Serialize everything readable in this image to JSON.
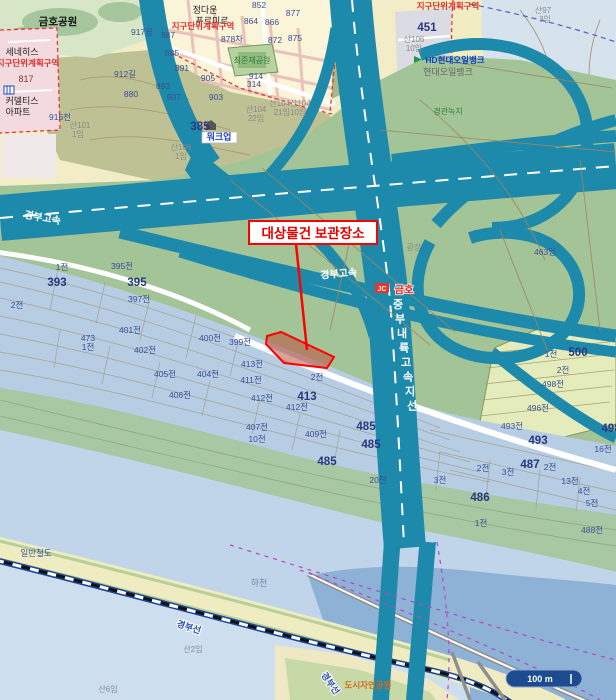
{
  "map": {
    "annotation": {
      "label": "대상물건 보관장소"
    },
    "scale_bar": {
      "label": "100 m"
    },
    "junction": {
      "badge": "JC",
      "name": "금호"
    },
    "colors": {
      "highway_teal": "#1e8aab",
      "interchange_green": "#a3c497",
      "parcel_blue": "#b6cde4",
      "river_blue": "#8db2d6",
      "railway_blue": "#1c4694",
      "annotation_red": "#ff0000",
      "district_pink": "#f3dade",
      "land_yellow": "#f2edc6",
      "scalebar_navy": "#1d4b8f"
    },
    "labels": [
      {
        "t": "금호공원",
        "x": 58,
        "y": 25,
        "c": "blkb"
      },
      {
        "t": "정다운",
        "x": 205,
        "y": 13,
        "c": "blk"
      },
      {
        "t": "푸르미르",
        "x": 212,
        "y": 24,
        "c": "blk"
      },
      {
        "t": "지구단위계획구역",
        "x": 203,
        "y": 29,
        "c": "reds"
      },
      {
        "t": "지구단위계획구역",
        "x": 28,
        "y": 66,
        "c": "reds"
      },
      {
        "t": "지구단위계획구역",
        "x": 448,
        "y": 9,
        "c": "reds"
      },
      {
        "t": "세네히스",
        "x": 22,
        "y": 55,
        "c": "blk"
      },
      {
        "t": "817",
        "x": 26,
        "y": 82,
        "c": "brn"
      },
      {
        "t": "커델티스",
        "x": 22,
        "y": 104,
        "c": "blk"
      },
      {
        "t": "아파트",
        "x": 18,
        "y": 115,
        "c": "blk"
      },
      {
        "t": "916천",
        "x": 60,
        "y": 120,
        "c": "pn"
      },
      {
        "t": "산101",
        "x": 80,
        "y": 128,
        "c": "g"
      },
      {
        "t": "1임",
        "x": 78,
        "y": 137,
        "c": "g"
      },
      {
        "t": "917공",
        "x": 142,
        "y": 35,
        "c": "pn"
      },
      {
        "t": "912길",
        "x": 125,
        "y": 77,
        "c": "pn"
      },
      {
        "t": "852",
        "x": 259,
        "y": 8,
        "c": "pn"
      },
      {
        "t": "877",
        "x": 293,
        "y": 16,
        "c": "pn"
      },
      {
        "t": "864",
        "x": 251,
        "y": 24,
        "c": "pn"
      },
      {
        "t": "866",
        "x": 272,
        "y": 25,
        "c": "pn"
      },
      {
        "t": "887",
        "x": 168,
        "y": 38,
        "c": "pn"
      },
      {
        "t": "878차",
        "x": 232,
        "y": 42,
        "c": "pn"
      },
      {
        "t": "872",
        "x": 275,
        "y": 43,
        "c": "pn"
      },
      {
        "t": "875",
        "x": 295,
        "y": 41,
        "c": "pn"
      },
      {
        "t": "885",
        "x": 172,
        "y": 56,
        "c": "pn"
      },
      {
        "t": "891",
        "x": 182,
        "y": 71,
        "c": "pn"
      },
      {
        "t": "905",
        "x": 208,
        "y": 81,
        "c": "pn"
      },
      {
        "t": "914",
        "x": 256,
        "y": 79,
        "c": "pn"
      },
      {
        "t": "893",
        "x": 163,
        "y": 89,
        "c": "pn"
      },
      {
        "t": "880",
        "x": 131,
        "y": 97,
        "c": "pn"
      },
      {
        "t": "907",
        "x": 174,
        "y": 100,
        "c": "pn"
      },
      {
        "t": "903",
        "x": 216,
        "y": 100,
        "c": "pn"
      },
      {
        "t": "385",
        "x": 200,
        "y": 130,
        "c": "b"
      },
      {
        "t": "워크업",
        "x": 219,
        "y": 140,
        "c": "chip"
      },
      {
        "t": "산104",
        "x": 256,
        "y": 112,
        "c": "g"
      },
      {
        "t": "22임",
        "x": 256,
        "y": 121,
        "c": "g"
      },
      {
        "t": "산104산104",
        "x": 290,
        "y": 106,
        "c": "g"
      },
      {
        "t": "21임10임",
        "x": 290,
        "y": 115,
        "c": "g"
      },
      {
        "t": "산106",
        "x": 181,
        "y": 150,
        "c": "g"
      },
      {
        "t": "1임",
        "x": 181,
        "y": 159,
        "c": "g"
      },
      {
        "t": "최준재공원",
        "x": 252,
        "y": 63,
        "c": "grn"
      },
      {
        "t": "314",
        "x": 254,
        "y": 87,
        "c": "pn"
      },
      {
        "t": "451",
        "x": 427,
        "y": 31,
        "c": "b"
      },
      {
        "t": "산106",
        "x": 414,
        "y": 42,
        "c": "g"
      },
      {
        "t": "10임",
        "x": 414,
        "y": 51,
        "c": "g"
      },
      {
        "t": "HD현대오일뱅크",
        "x": 455,
        "y": 63,
        "c": "hd"
      },
      {
        "t": "현대오일뱅크",
        "x": 448,
        "y": 75,
        "c": "gb"
      },
      {
        "t": "산97",
        "x": 543,
        "y": 13,
        "c": "g"
      },
      {
        "t": "3임",
        "x": 545,
        "y": 22,
        "c": "g"
      },
      {
        "t": "경관녹지",
        "x": 448,
        "y": 114,
        "c": "grn"
      },
      {
        "t": "광장",
        "x": 414,
        "y": 250,
        "c": "g"
      },
      {
        "t": "463임",
        "x": 545,
        "y": 255,
        "c": "pn"
      },
      {
        "t": "경부고속",
        "x": 42,
        "y": 221,
        "c": "wrd",
        "r": 10,
        "n": "road-label-gyeongbu-expressway"
      },
      {
        "t": "경부고속",
        "x": 339,
        "y": 277,
        "c": "wrd",
        "r": -5,
        "n": "road-label-gyeongbu-expressway"
      },
      {
        "t": "중부내륙고속지선",
        "x": 398,
        "y": 308,
        "c": "wrdv",
        "n": "road-label-jungbunaeryuk-branch"
      },
      {
        "t": "1전",
        "x": 62,
        "y": 270,
        "c": "pn"
      },
      {
        "t": "395전",
        "x": 122,
        "y": 269,
        "c": "pn"
      },
      {
        "t": "393",
        "x": 57,
        "y": 286,
        "c": "b"
      },
      {
        "t": "395",
        "x": 137,
        "y": 286,
        "c": "b"
      },
      {
        "t": "2전",
        "x": 17,
        "y": 308,
        "c": "pn"
      },
      {
        "t": "397전",
        "x": 139,
        "y": 302,
        "c": "pn"
      },
      {
        "t": "401전",
        "x": 130,
        "y": 333,
        "c": "pn"
      },
      {
        "t": "473",
        "x": 88,
        "y": 341,
        "c": "pn"
      },
      {
        "t": "1전",
        "x": 88,
        "y": 350,
        "c": "pn"
      },
      {
        "t": "402전",
        "x": 145,
        "y": 353,
        "c": "pn"
      },
      {
        "t": "405전",
        "x": 165,
        "y": 377,
        "c": "pn"
      },
      {
        "t": "404전",
        "x": 208,
        "y": 377,
        "c": "pn"
      },
      {
        "t": "406전",
        "x": 180,
        "y": 398,
        "c": "pn"
      },
      {
        "t": "400전",
        "x": 210,
        "y": 341,
        "c": "pn"
      },
      {
        "t": "399전",
        "x": 240,
        "y": 345,
        "c": "pn"
      },
      {
        "t": "413전",
        "x": 252,
        "y": 367,
        "c": "pn"
      },
      {
        "t": "411전",
        "x": 251,
        "y": 383,
        "c": "pn"
      },
      {
        "t": "2전",
        "x": 317,
        "y": 380,
        "c": "pn"
      },
      {
        "t": "412전",
        "x": 262,
        "y": 401,
        "c": "pn"
      },
      {
        "t": "413",
        "x": 307,
        "y": 400,
        "c": "b"
      },
      {
        "t": "412전",
        "x": 297,
        "y": 410,
        "c": "pn"
      },
      {
        "t": "407전",
        "x": 257,
        "y": 430,
        "c": "pn"
      },
      {
        "t": "10전",
        "x": 257,
        "y": 442,
        "c": "pn"
      },
      {
        "t": "409전",
        "x": 316,
        "y": 437,
        "c": "pn"
      },
      {
        "t": "485",
        "x": 327,
        "y": 465,
        "c": "b"
      },
      {
        "t": "485",
        "x": 366,
        "y": 430,
        "c": "b"
      },
      {
        "t": "485",
        "x": 371,
        "y": 448,
        "c": "b"
      },
      {
        "t": "486",
        "x": 480,
        "y": 501,
        "c": "b"
      },
      {
        "t": "487",
        "x": 530,
        "y": 468,
        "c": "b"
      },
      {
        "t": "2전",
        "x": 550,
        "y": 470,
        "c": "pn"
      },
      {
        "t": "2전",
        "x": 483,
        "y": 471,
        "c": "pn"
      },
      {
        "t": "3전",
        "x": 508,
        "y": 475,
        "c": "pn"
      },
      {
        "t": "13전",
        "x": 570,
        "y": 484,
        "c": "pn"
      },
      {
        "t": "4전",
        "x": 584,
        "y": 494,
        "c": "pn"
      },
      {
        "t": "5전",
        "x": 592,
        "y": 506,
        "c": "pn"
      },
      {
        "t": "488전",
        "x": 592,
        "y": 533,
        "c": "pn"
      },
      {
        "t": "1전",
        "x": 481,
        "y": 526,
        "c": "pn"
      },
      {
        "t": "20전",
        "x": 378,
        "y": 483,
        "c": "pn"
      },
      {
        "t": "3전",
        "x": 440,
        "y": 483,
        "c": "pn"
      },
      {
        "t": "493전",
        "x": 512,
        "y": 429,
        "c": "pn"
      },
      {
        "t": "493",
        "x": 538,
        "y": 444,
        "c": "b"
      },
      {
        "t": "496전",
        "x": 538,
        "y": 411,
        "c": "pn"
      },
      {
        "t": "498전",
        "x": 553,
        "y": 387,
        "c": "pn"
      },
      {
        "t": "500",
        "x": 578,
        "y": 356,
        "c": "b"
      },
      {
        "t": "1전",
        "x": 551,
        "y": 357,
        "c": "pn"
      },
      {
        "t": "2전",
        "x": 563,
        "y": 373,
        "c": "pn"
      },
      {
        "t": "16전",
        "x": 603,
        "y": 452,
        "c": "pn"
      },
      {
        "t": "498",
        "x": 611,
        "y": 432,
        "c": "b"
      },
      {
        "t": "일반철도",
        "x": 36,
        "y": 556,
        "c": "pn"
      },
      {
        "t": "하천",
        "x": 259,
        "y": 586,
        "c": "gb2"
      },
      {
        "t": "경부선",
        "x": 188,
        "y": 630,
        "c": "rail",
        "r": 18,
        "n": "railway-label-gyeongbu-line"
      },
      {
        "t": "경부선",
        "x": 328,
        "y": 685,
        "c": "rail",
        "r": 55,
        "n": "railway-label-gyeongbu-line"
      },
      {
        "t": "산2임",
        "x": 193,
        "y": 652,
        "c": "g"
      },
      {
        "t": "산6임",
        "x": 108,
        "y": 692,
        "c": "g"
      },
      {
        "t": "도시자연공원",
        "x": 368,
        "y": 688,
        "c": "or"
      }
    ]
  }
}
